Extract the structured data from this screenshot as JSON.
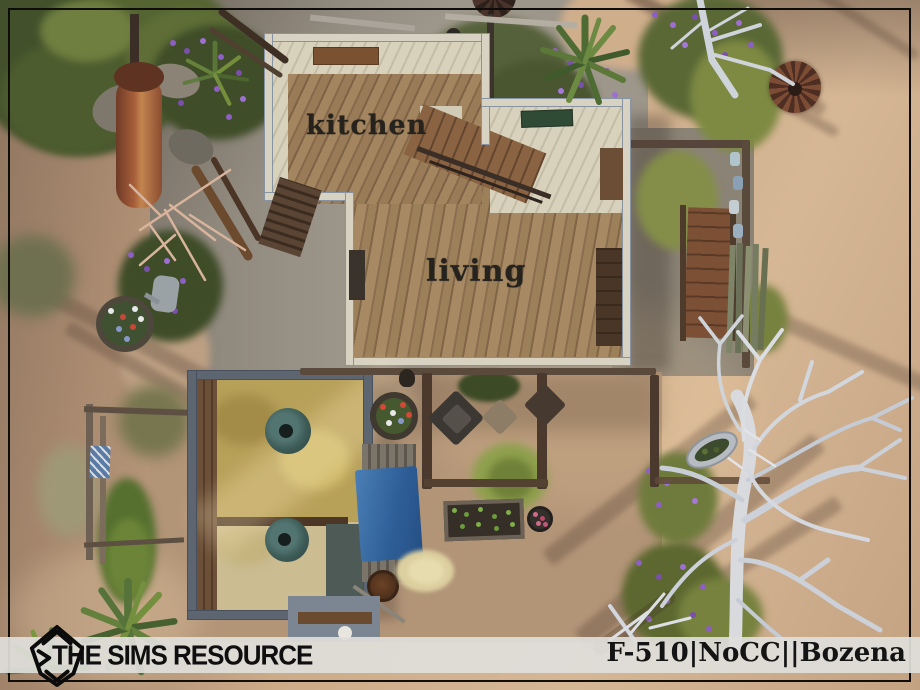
{
  "scene": {
    "description": "The Sims 4 top-down desert lot floorplan screenshot",
    "rooms": {
      "kitchen": "kitchen",
      "living": "living"
    },
    "objects": [
      "house",
      "barn",
      "pergola",
      "lumber-pile-tarp",
      "garden-bed",
      "dead-tree",
      "boiler",
      "planters"
    ]
  },
  "footer": {
    "brand": "THE SIMS RESOURCE",
    "watermark": "F-510|NoCC||Bozena",
    "logo_icon": "tsr-plumbob-logo"
  },
  "colors": {
    "sand": "#c9a786",
    "concrete": "#9d968a",
    "wall": "#d8d2c2",
    "wall_edge": "#8793a0",
    "wood_floor": "#9c8059",
    "barn_wall": "#5d6571",
    "hay": "#b7a058",
    "tarp_blue": "#3c70a8",
    "teal_bowl": "#3c5a56",
    "bar_background": "#dfdedb",
    "text": "#141414"
  }
}
